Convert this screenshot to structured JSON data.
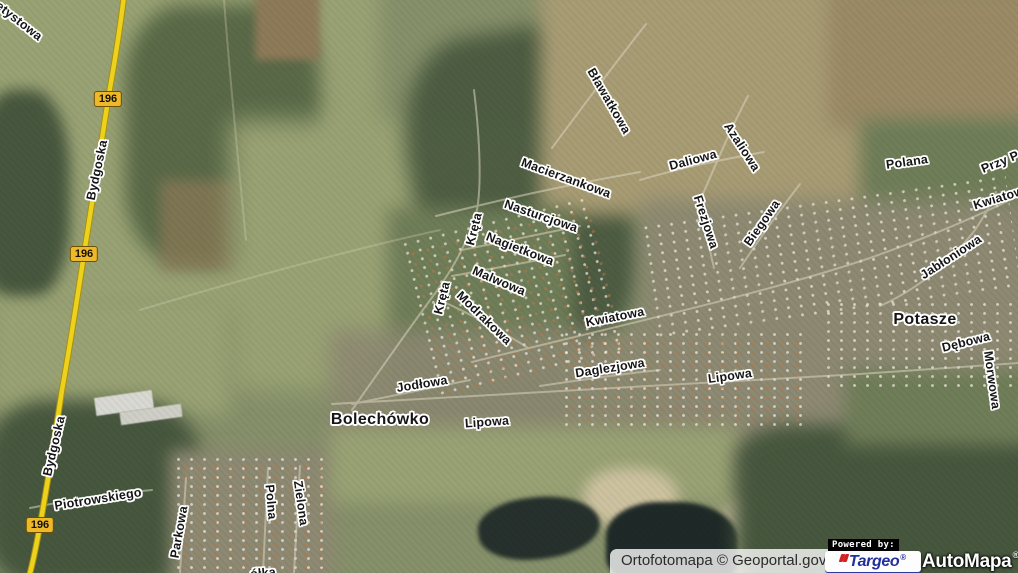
{
  "map": {
    "road_badges": [
      {
        "text": "196",
        "x": 108,
        "y": 99
      },
      {
        "text": "196",
        "x": 84,
        "y": 254
      },
      {
        "text": "196",
        "x": 40,
        "y": 525
      }
    ],
    "street_labels": [
      {
        "text": "etystowa",
        "x": 19,
        "y": 21,
        "rot": 38
      },
      {
        "text": "Bydgoska",
        "x": 97,
        "y": 170,
        "rot": -78
      },
      {
        "text": "Bydgoska",
        "x": 54,
        "y": 446,
        "rot": -77
      },
      {
        "text": "Bławatkowa",
        "x": 609,
        "y": 101,
        "rot": 60
      },
      {
        "text": "Macierzankowa",
        "x": 566,
        "y": 178,
        "rot": 20
      },
      {
        "text": "Nasturcjowa",
        "x": 541,
        "y": 216,
        "rot": 19
      },
      {
        "text": "Daliowa",
        "x": 693,
        "y": 160,
        "rot": -15
      },
      {
        "text": "Azaliowa",
        "x": 742,
        "y": 147,
        "rot": 57
      },
      {
        "text": "Polana",
        "x": 907,
        "y": 162,
        "rot": -8
      },
      {
        "text": "Przy P",
        "x": 1000,
        "y": 162,
        "rot": -22
      },
      {
        "text": "Kwiatowa",
        "x": 1002,
        "y": 197,
        "rot": -17
      },
      {
        "text": "Frezjowa",
        "x": 706,
        "y": 222,
        "rot": 72
      },
      {
        "text": "Biegowa",
        "x": 762,
        "y": 223,
        "rot": -55
      },
      {
        "text": "Jabłoniowa",
        "x": 951,
        "y": 257,
        "rot": -33
      },
      {
        "text": "Kręta",
        "x": 474,
        "y": 229,
        "rot": -76
      },
      {
        "text": "Nagietkowa",
        "x": 520,
        "y": 249,
        "rot": 21
      },
      {
        "text": "Malwowa",
        "x": 499,
        "y": 281,
        "rot": 23
      },
      {
        "text": "Kręta",
        "x": 442,
        "y": 298,
        "rot": -76
      },
      {
        "text": "Modrakowa",
        "x": 484,
        "y": 318,
        "rot": 44
      },
      {
        "text": "Kwiatowa",
        "x": 615,
        "y": 317,
        "rot": -11
      },
      {
        "text": "Dębowa",
        "x": 966,
        "y": 342,
        "rot": -14
      },
      {
        "text": "Morwowa",
        "x": 992,
        "y": 380,
        "rot": 82
      },
      {
        "text": "Lipowa",
        "x": 730,
        "y": 376,
        "rot": -8
      },
      {
        "text": "Daglezjowa",
        "x": 610,
        "y": 368,
        "rot": -9
      },
      {
        "text": "Jodłowa",
        "x": 422,
        "y": 384,
        "rot": -9
      },
      {
        "text": "Lipowa",
        "x": 487,
        "y": 422,
        "rot": -4
      },
      {
        "text": "Piotrowskiego",
        "x": 98,
        "y": 499,
        "rot": -9
      },
      {
        "text": "Parkowa",
        "x": 179,
        "y": 532,
        "rot": -80
      },
      {
        "text": "Polna",
        "x": 271,
        "y": 502,
        "rot": 85
      },
      {
        "text": "Zielona",
        "x": 301,
        "y": 503,
        "rot": 82
      },
      {
        "text": "ółka",
        "x": 263,
        "y": 573,
        "rot": -5
      }
    ],
    "place_labels": [
      {
        "text": "Bolechówko",
        "x": 380,
        "y": 420
      },
      {
        "text": "Potasze",
        "x": 925,
        "y": 320
      }
    ]
  },
  "attribution": {
    "text": "Ortofotomapa © Geoportal.gov.pl"
  },
  "branding": {
    "powered_by": "Powered by:",
    "targeo": "Targeo",
    "automapa": "AutoMapa",
    "reg_mark": "®"
  },
  "colors": {
    "road_yellow": "#ecd21c",
    "road_casing": "#a88f0e",
    "badge_bg": "#edb829",
    "targeo_blue": "#23309b",
    "targeo_red": "#cf2222",
    "powered_bg": "#000000",
    "automapa_text": "#ffffff"
  }
}
